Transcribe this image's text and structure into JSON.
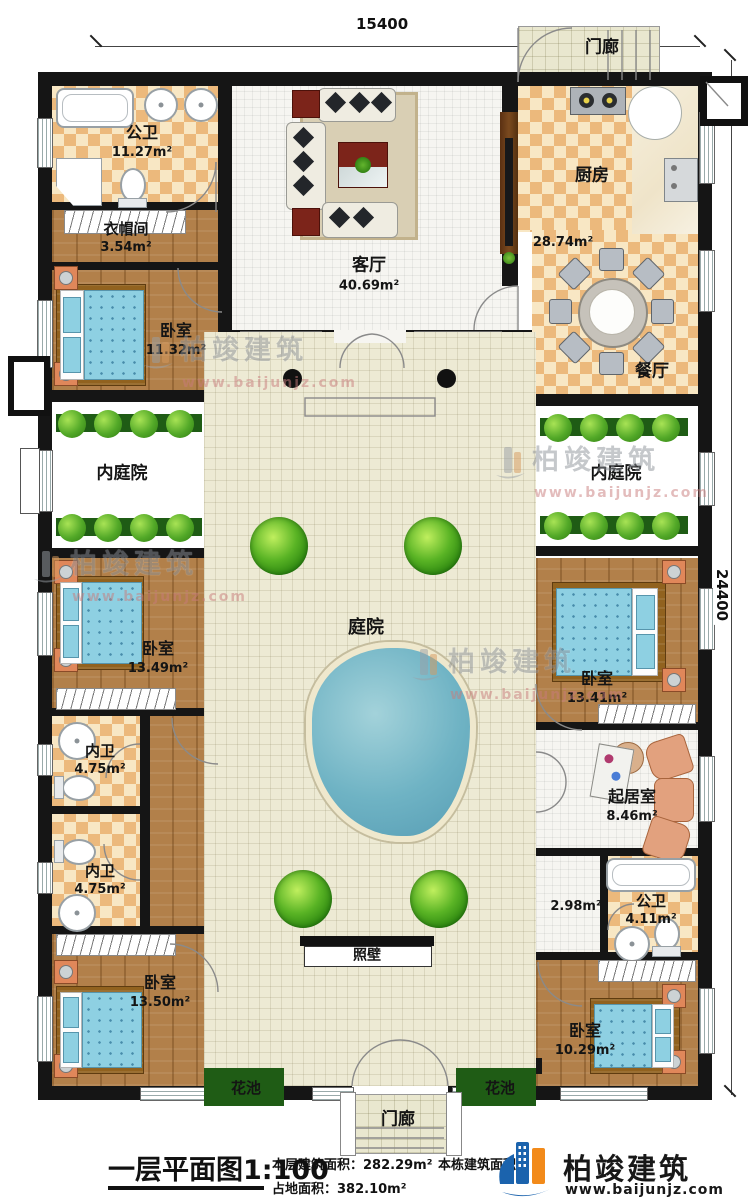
{
  "dimensions": {
    "top": "15400",
    "right": "24400"
  },
  "watermark": {
    "brand": "柏竣建筑",
    "url": "www.baijunjz.com"
  },
  "rooms": {
    "porch_top": {
      "name": "门廊"
    },
    "public_bath_top": {
      "name": "公卫",
      "area": "11.27m²"
    },
    "cloakroom": {
      "name": "衣帽间",
      "area": "3.54m²"
    },
    "bedroom_top_left": {
      "name": "卧室",
      "area": "11.32m²"
    },
    "living_room": {
      "name": "客厅",
      "area": "40.69m²"
    },
    "kitchen": {
      "name": "厨房",
      "area": "28.74m²"
    },
    "dining_room": {
      "name": "餐厅"
    },
    "inner_courtyard_left": {
      "name": "内庭院"
    },
    "inner_courtyard_right": {
      "name": "内庭院"
    },
    "bedroom_mid_left": {
      "name": "卧室",
      "area": "13.49m²"
    },
    "inner_bath_upper": {
      "name": "内卫",
      "area": "4.75m²"
    },
    "inner_bath_lower": {
      "name": "内卫",
      "area": "4.75m²"
    },
    "bedroom_bottom_left": {
      "name": "卧室",
      "area": "13.50m²"
    },
    "courtyard": {
      "name": "庭院"
    },
    "bedroom_mid_right": {
      "name": "卧室",
      "area": "13.41m²"
    },
    "sitting_room": {
      "name": "起居室",
      "area": "8.46m²"
    },
    "hallway": {
      "area": "2.98m²"
    },
    "public_bath_right": {
      "name": "公卫",
      "area": "4.11m²"
    },
    "bedroom_bottom_right": {
      "name": "卧室",
      "area": "10.29m²"
    },
    "screen_wall": {
      "name": "照壁"
    },
    "flower_bed_left": {
      "name": "花池"
    },
    "flower_bed_right": {
      "name": "花池"
    },
    "porch_bottom": {
      "name": "门廊"
    }
  },
  "footer": {
    "title": "一层平面图",
    "scale": "1:100",
    "floor_area_label": "本层建筑面积：",
    "floor_area_value": "282.29m²",
    "site_area_label": "占地面积：",
    "site_area_value": "382.10m²",
    "building_area_label": "本栋建筑面积：",
    "logo_brand": "柏竣建筑",
    "logo_url": "www.baijunjz.com"
  }
}
